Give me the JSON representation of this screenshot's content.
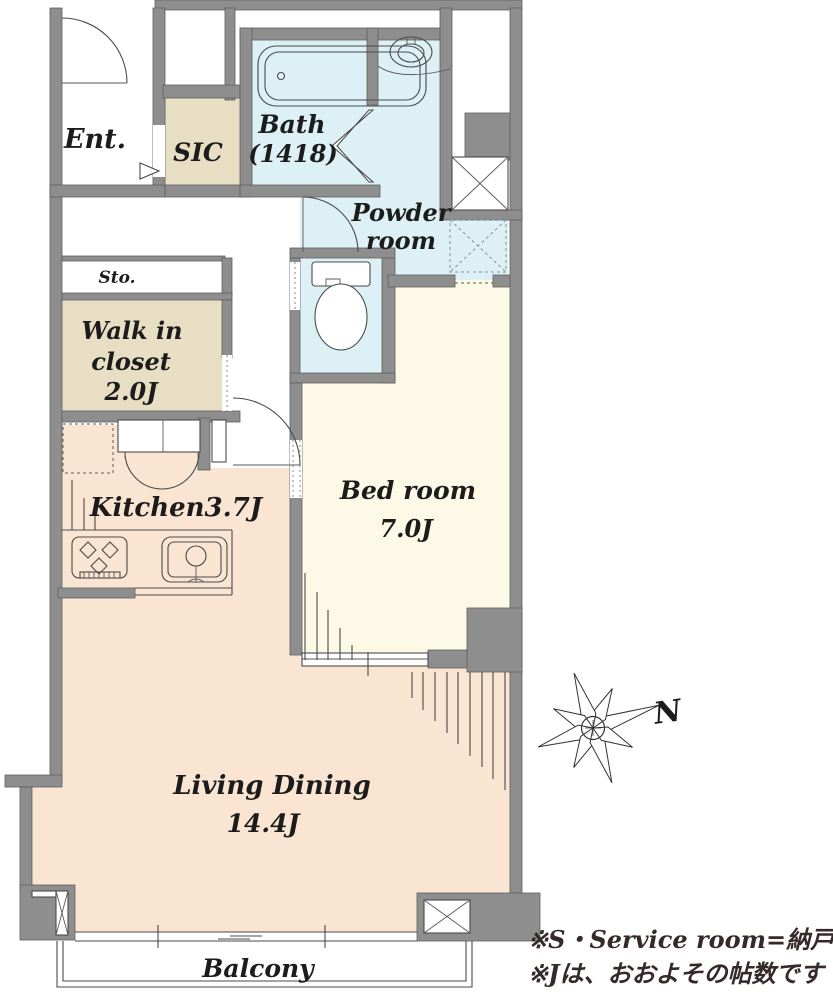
{
  "plan": {
    "rooms": {
      "ent": {
        "label": "Ent."
      },
      "sic": {
        "label": "SIC"
      },
      "bath": {
        "name": "Bath",
        "size": "(1418)"
      },
      "powder": {
        "name_line1": "Powder",
        "name_line2": "room"
      },
      "sto": {
        "label": "Sto."
      },
      "walk_in_closet": {
        "line1": "Walk in",
        "line2": "closet",
        "line3": "2.0J"
      },
      "kitchen": {
        "label": "Kitchen3.7J"
      },
      "bedroom": {
        "name": "Bed room",
        "size": "7.0J"
      },
      "living_dining": {
        "name": "Living Dining",
        "size": "14.4J"
      },
      "balcony": {
        "label": "Balcony"
      }
    },
    "compass": {
      "north": "N"
    },
    "notes": {
      "line1": "※S・Service room=納戸",
      "line2": "※Jは、おおよその帖数です"
    },
    "colors": {
      "wall": "#8e8e8e",
      "floor_main": "#f9e5d2",
      "floor_bedroom": "#fcfae7",
      "wet_area": "#dcf0f6",
      "closet": "#e7dec4",
      "text": "#1c1c1c",
      "note_text": "#362929"
    }
  }
}
